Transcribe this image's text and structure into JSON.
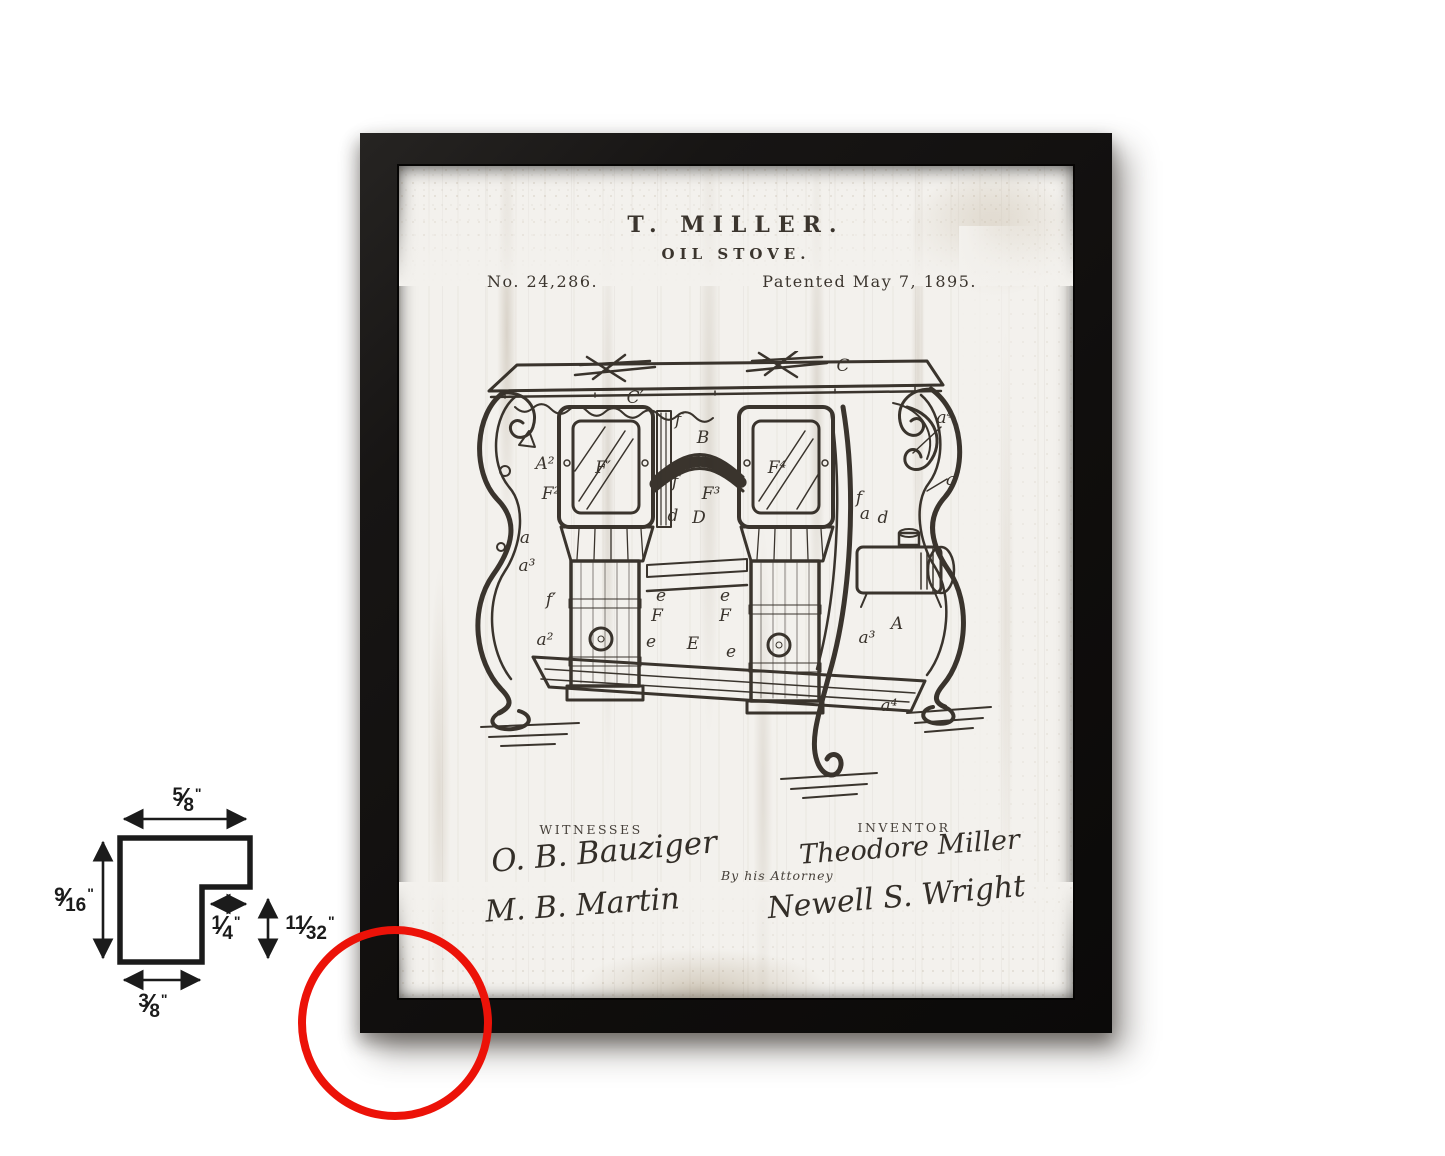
{
  "patent": {
    "title_line1": "T. MILLER.",
    "title_line2": "OIL STOVE.",
    "number": "No. 24,286.",
    "date": "Patented May 7, 1895.",
    "witnesses_label": "WITNESSES",
    "inventor_label": "INVENTOR",
    "attorney_label": "By his Attorney",
    "witness_signature_1": "O. B. Bauziger",
    "witness_signature_2": "M. B. Martin",
    "inventor_signature": "Theodore Miller",
    "attorney_signature": "Newell S. Wright"
  },
  "drawing": {
    "labels": [
      "C",
      "C′",
      "f",
      "B",
      "A²",
      "F′",
      "F⁴",
      "F²",
      "f",
      "F³",
      "a⁴",
      "a′",
      "a",
      "d",
      "D",
      "f",
      "a",
      "d",
      "a³",
      "f′",
      "a²",
      "e",
      "e",
      "F",
      "F",
      "e",
      "E",
      "e",
      "A",
      "a³",
      "a⁴"
    ]
  },
  "dimensions": {
    "slash": "⁄",
    "top": {
      "num": "5",
      "den": "8",
      "unit": "\""
    },
    "left": {
      "num": "9",
      "den": "16",
      "unit": "\""
    },
    "notch": {
      "num": "1",
      "den": "4",
      "unit": "\""
    },
    "right": {
      "num": "11",
      "den": "32",
      "unit": "\""
    },
    "bottom": {
      "num": "3",
      "den": "8",
      "unit": "\""
    }
  },
  "colors": {
    "frame": "#141210",
    "accent_red": "#ec1208",
    "paper": "#f3f1ed"
  }
}
